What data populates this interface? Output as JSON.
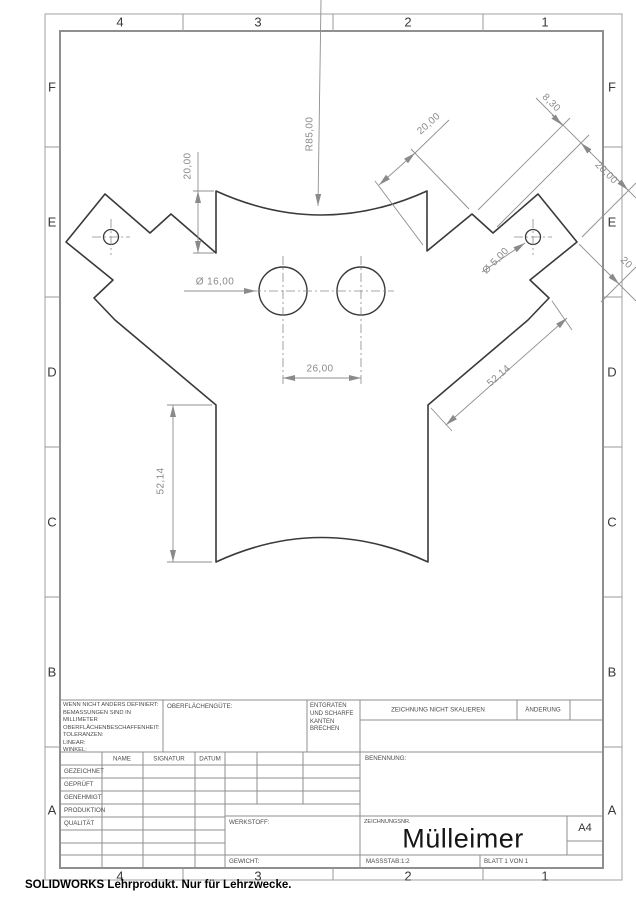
{
  "sheet": {
    "footer": "SOLIDWORKS Lehrprodukt. Nur für Lehrzwecke.",
    "zones": {
      "columns": [
        "4",
        "3",
        "2",
        "1"
      ],
      "rows": [
        "F",
        "E",
        "D",
        "C",
        "B",
        "A"
      ]
    },
    "colors": {
      "part_line": "#3a3a3a",
      "dimension": "#8f8f8f",
      "border": "#9a9a9a",
      "dim_text": "#8a8a8a"
    }
  },
  "dimensions": {
    "edge_height": "20,00",
    "top_radius": "R85,00",
    "right_edge_20": "20,00",
    "notch_830": "8,30",
    "border_20": "20,00",
    "border_20_clipped": "20",
    "small_hole": "Ø 5,00",
    "large_hole": "Ø 16,00",
    "hole_spacing": "26,00",
    "left_height": "52,14",
    "right_diagonal": "52,14"
  },
  "title_block": {
    "tolerance_note": "WENN NICHT ANDERS DEFINIERT:\nBEMASSUNGEN SIND IN MILLIMETER\nOBERFLÄCHENBESCHAFFENHEIT:\nTOLERANZEN:\n   LINEAR:\n   WINKEL:",
    "surface_label": "OBERFLÄCHENGÜTE:",
    "deburr_note": "ENTGRATEN\nUND SCHARFE\nKANTEN\nBRECHEN",
    "no_scale": "ZEICHNUNG NICHT SKALIEREN",
    "change_label": "ÄNDERUNG",
    "name_header": "NAME",
    "signature_header": "SIGNATUR",
    "date_header": "DATUM",
    "row_labels": [
      "GEZEICHNET",
      "GEPRÜFT",
      "GENEHMIGT",
      "PRODUKTION",
      "QUALITÄT"
    ],
    "benennung_label": "BENENNUNG:",
    "drawing_no_label": "ZEICHNUNGSNR.",
    "title": "Mülleimer",
    "format": "A4",
    "material_label": "WERKSTOFF:",
    "weight_label": "GEWICHT:",
    "scale_label": "MASSSTAB:1:2",
    "sheet_label": "BLATT 1 VON 1"
  }
}
